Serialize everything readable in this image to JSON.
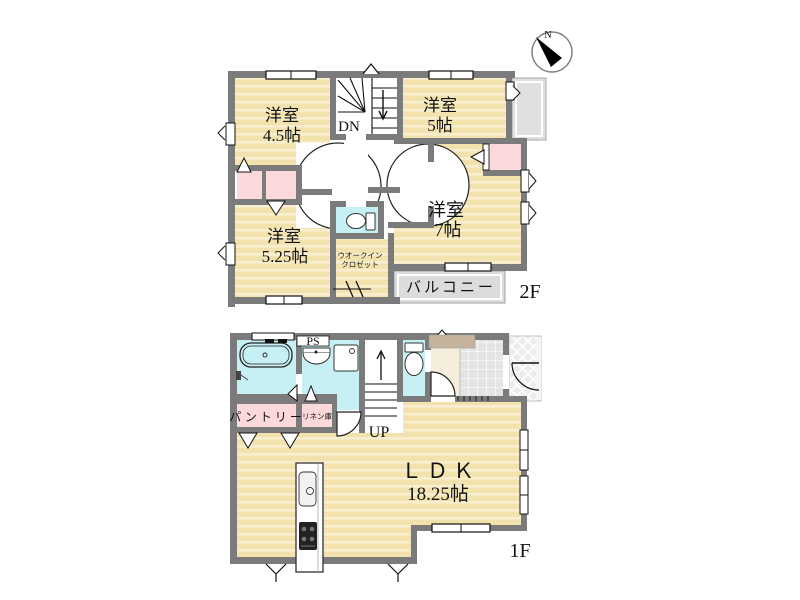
{
  "compass": {
    "north_label": "N"
  },
  "floor_2f": {
    "floor_label": "2F",
    "room_45_name": "洋室",
    "room_45_size": "4.5帖",
    "room_5_name": "洋室",
    "room_5_size": "5帖",
    "room_7_name": "洋室",
    "room_7_size": "7帖",
    "room_525_name": "洋室",
    "room_525_size": "5.25帖",
    "stairs_label": "DN",
    "wic_name_line1": "ウオークイン",
    "wic_name_line2": "クロゼット",
    "balcony_label": "バルコニー"
  },
  "floor_1f": {
    "floor_label": "1F",
    "ldk_name": "ＬＤＫ",
    "ldk_size": "18.25帖",
    "pantry_label": "パントリー",
    "linen_label": "リネン庫",
    "ps_label": "PS",
    "stairs_label": "UP"
  },
  "palette": {
    "wall": "#7b7b7b",
    "floor_base": "#f2e3ae",
    "floor_stripe": "#f9efd0",
    "water_area": "#c6f0f3",
    "closet_pink": "#fbd8da",
    "balcony_gray": "#dcdcdc",
    "hallway": "#f5eedd",
    "shoe_cabinet": "#c6b39c"
  }
}
